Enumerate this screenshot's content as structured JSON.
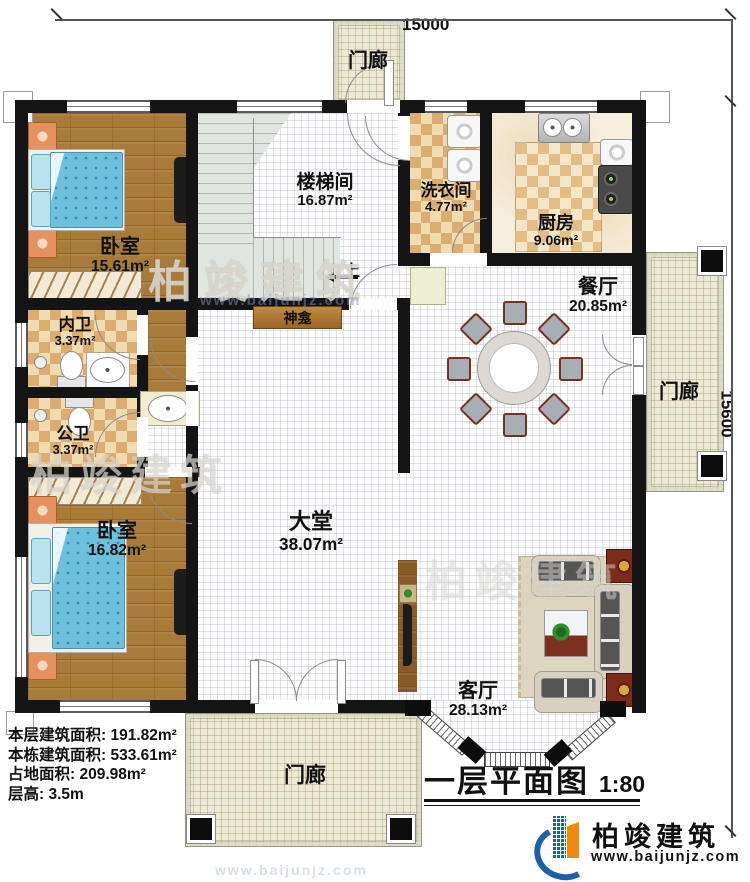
{
  "dimensions": {
    "top": "15000",
    "right": "15600"
  },
  "rooms": {
    "porch_top": {
      "label": "门廊"
    },
    "bedroom1": {
      "label": "卧室",
      "area": "15.61m²"
    },
    "stairwell": {
      "label": "楼梯间",
      "area": "16.87m²"
    },
    "laundry": {
      "label": "洗衣间",
      "area": "4.77m²"
    },
    "kitchen": {
      "label": "厨房",
      "area": "9.06m²"
    },
    "dining": {
      "label": "餐厅",
      "area": "20.85m²"
    },
    "porch_right": {
      "label": "门廊"
    },
    "inner_bath": {
      "label": "内卫",
      "area": "3.37m²"
    },
    "public_bath": {
      "label": "公卫",
      "area": "3.37m²"
    },
    "hall": {
      "label": "大堂",
      "area": "38.07m²"
    },
    "bedroom2": {
      "label": "卧室",
      "area": "16.82m²"
    },
    "living": {
      "label": "客厅",
      "area": "28.13m²"
    },
    "porch_bottom": {
      "label": "门廊"
    },
    "shrine": {
      "label": "神龛"
    },
    "stairs_up": {
      "label": "上"
    }
  },
  "stats": {
    "line1": "本层建筑面积: 191.82m²",
    "line2": "本栋建筑面积: 533.61m²",
    "line3": "占地面积: 209.98m²",
    "line4": "层高: 3.5m"
  },
  "title": {
    "text": "一层平面图",
    "scale": "1:80"
  },
  "logo": {
    "name": "柏竣建筑",
    "url": "www.baijunjz.com"
  },
  "watermark": {
    "text": "柏竣建筑",
    "url": "www.baijunjz.com"
  }
}
